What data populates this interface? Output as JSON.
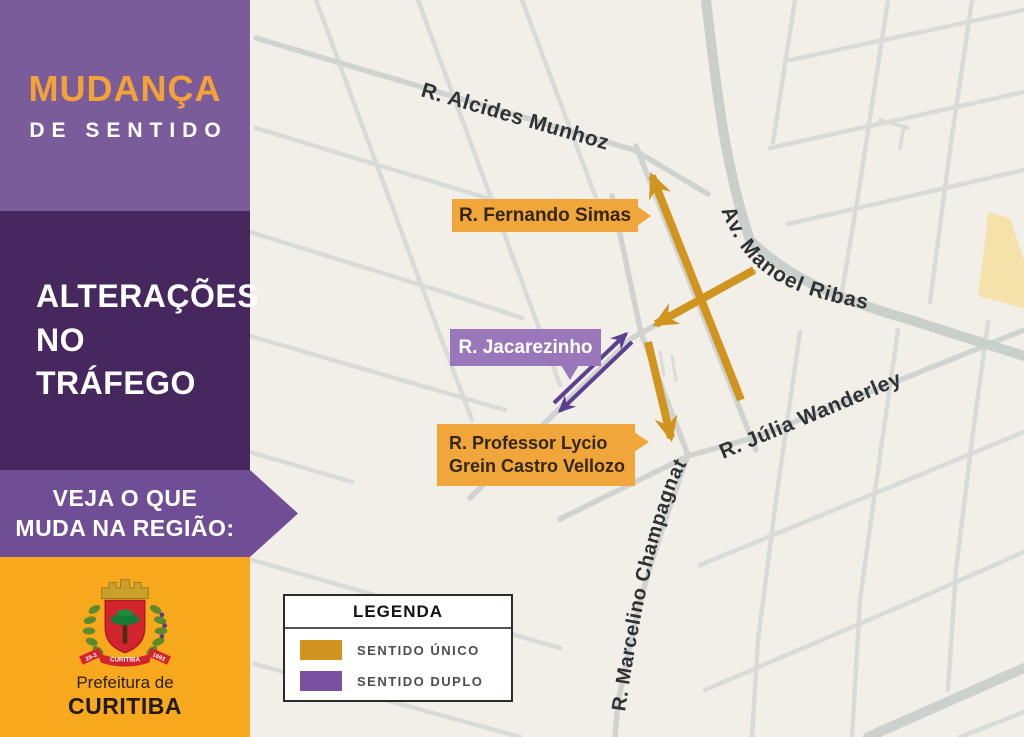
{
  "poster": {
    "headline": {
      "line1": "MUDANÇA",
      "line2": "DE SENTIDO"
    },
    "subheadline": {
      "line1": "ALTERAÇÕES",
      "line2": "NO TRÁFEGO"
    },
    "banner": {
      "line1": "VEJA O QUE",
      "line2": "MUDA NA REGIÃO:"
    },
    "footer": {
      "org_line1": "Prefeitura de",
      "org_line2": "CURITIBA",
      "crest": {
        "ribbon": "CURITIBA",
        "left_tail": "29-3",
        "right_tail": "1693"
      }
    }
  },
  "map": {
    "streets": {
      "alcides": "R. Alcides Munhoz",
      "manoel": "Av. Manoel Ribas",
      "julia": "R. Júlia Wanderley",
      "champagnat": "R. Marcelino Champagnat"
    },
    "callouts": {
      "fernando": "R. Fernando Simas",
      "jacarezinho": "R. Jacarezinho",
      "professor_line1": "R. Professor Lycio",
      "professor_line2": "Grein Castro Vellozo"
    }
  },
  "legend": {
    "title": "LEGENDA",
    "items": [
      {
        "label": "SENTIDO ÚNICO",
        "color": "#d0941f"
      },
      {
        "label": "SENTIDO DUPLO",
        "color": "#7a50a3"
      }
    ]
  },
  "colors": {
    "one_way": "#d0941f",
    "two_way": "#5d3f91",
    "callout_gold": "#f0a63a",
    "callout_purple": "#9a77ba",
    "sidebar_purple": "#7b5c9b",
    "sidebar_dark_purple": "#46285f",
    "banner_purple": "#6f4e95",
    "brand_orange": "#f7a81d",
    "map_background": "#f2efe9",
    "street_gray": "#d8dbd7",
    "highlight_road_yellow": "#f4e2aa"
  }
}
